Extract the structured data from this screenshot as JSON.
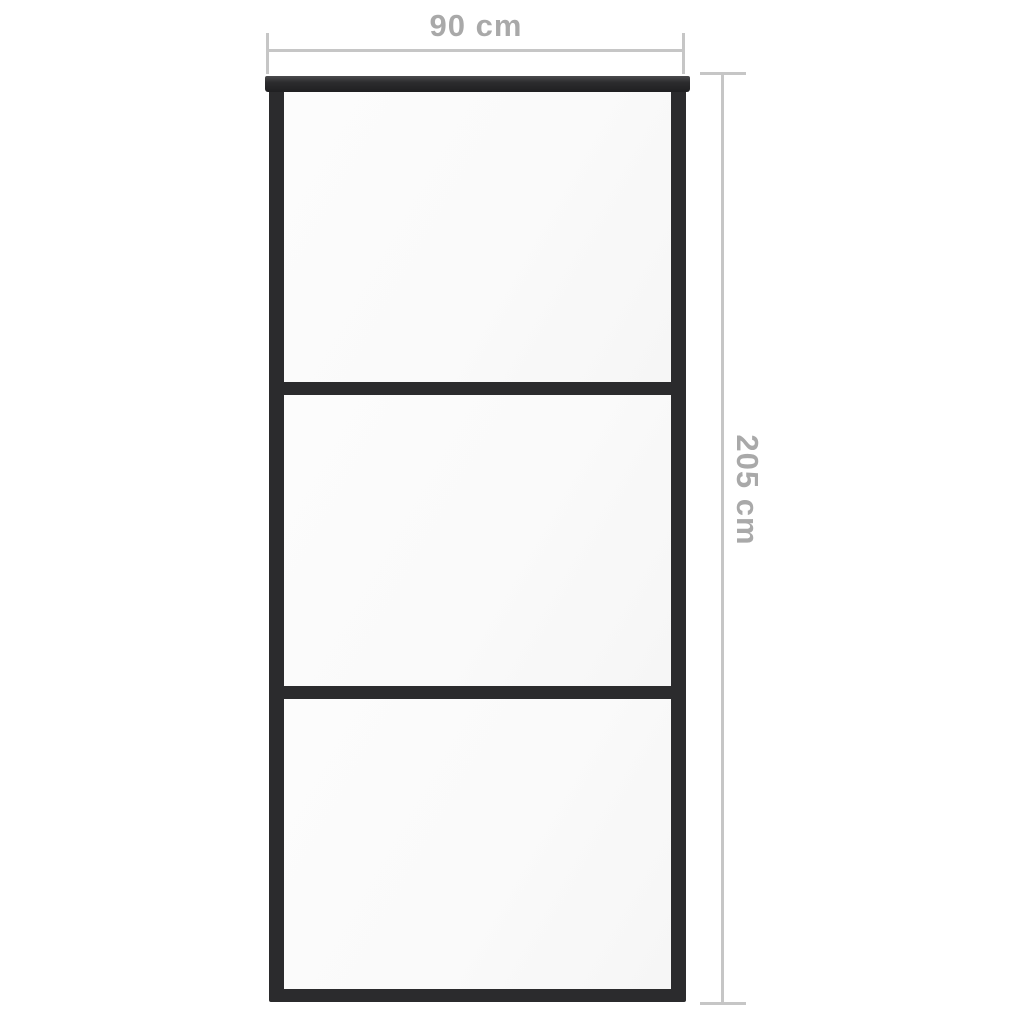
{
  "page": {
    "background_color": "#ffffff"
  },
  "door": {
    "description": "sliding door with dark frame and 3 glass panels",
    "panels": 3,
    "frame_color": "#2b2b2d",
    "glass_color": "#fafafa"
  },
  "dimensions": {
    "line_color": "#c6c6c6",
    "text_color": "#a9a9a9",
    "width": {
      "label": "90 cm"
    },
    "height": {
      "label": "205 cm"
    }
  }
}
